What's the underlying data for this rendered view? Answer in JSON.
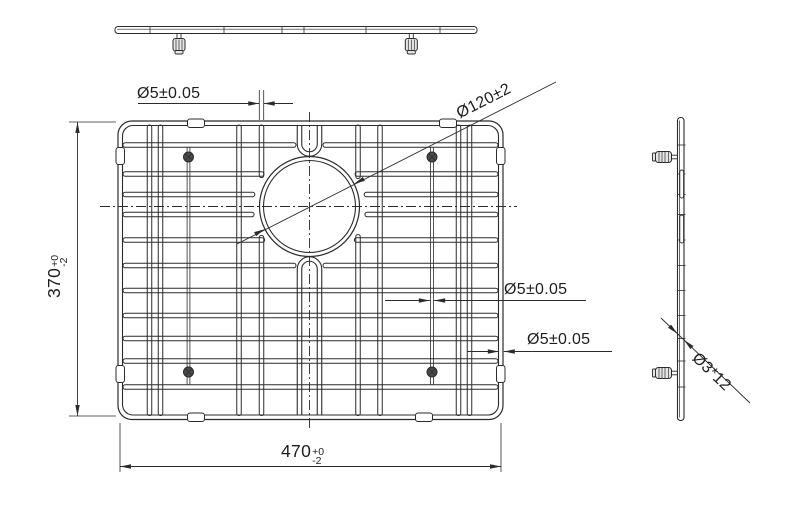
{
  "drawing": {
    "labels": {
      "height_dim": {
        "value": "370",
        "tol_plus": "+0",
        "tol_minus": "-2"
      },
      "width_dim": {
        "value": "470",
        "tol_plus": "+0",
        "tol_minus": "-2"
      },
      "wire_dia_top": "Ø5±0.05",
      "wire_dia_mid": "Ø5±0.05",
      "wire_dia_frame": "Ø5±0.05",
      "hole_dia": "Ø120±2",
      "leg_pin": "Ø3*12"
    },
    "colors": {
      "line": "#2b2b2b",
      "thin": "#3a3a3a",
      "background": "#ffffff",
      "foot_fill": "#4a4a4a",
      "clip_fill": "#ffffff",
      "shade_fill": "#e6e6e6"
    },
    "geometry": {
      "canvas": {
        "w": 800,
        "h": 516
      },
      "top_view": {
        "bar": {
          "x1": 115,
          "x2": 477,
          "y1": 26.5,
          "y2": 33.5,
          "rx": 3,
          "inner_y": 29.2
        },
        "ticks": [
          150,
          224,
          282,
          304,
          366,
          440
        ],
        "feet_x": [
          179,
          411.3
        ]
      },
      "front_view": {
        "frame": {
          "x1": 118,
          "y1": 121,
          "x2": 503,
          "y2": 419.5,
          "rx": 14,
          "t": 4.5
        },
        "h_wires": [
          145,
          174,
          194.5,
          214.5,
          240,
          265.5,
          290.5,
          315.5,
          338.5,
          361,
          387
        ],
        "h_gap_special": [
          145,
          265.5
        ],
        "v_wires": [
          149.5,
          160.5,
          239,
          261.5,
          358,
          380,
          458.5,
          469.5
        ],
        "v_interrupted": [
          261.5,
          358
        ],
        "wire_t": 4.5,
        "center_col": {
          "x_left": 299.5,
          "x_right": 319.5,
          "u_top_y": 144,
          "u_bot_y": 269
        },
        "circle": {
          "cx": 309.5,
          "cy": 206.5,
          "r": 50,
          "t": 4,
          "clear": 56
        },
        "legs": {
          "xs": [
            188.5,
            432
          ],
          "y1": 147,
          "y2": 385
        },
        "feet": [
          [
            188.5,
            157
          ],
          [
            432,
            157
          ],
          [
            188.5,
            372
          ],
          [
            432,
            372
          ]
        ],
        "clips": {
          "top_xs": [
            196,
            448
          ],
          "bottom_xs": [
            196,
            424
          ],
          "left_ys": [
            156,
            374
          ],
          "right_ys": [
            156,
            374
          ],
          "len": 17,
          "t": 8.5
        },
        "centerline_h": {
          "x1": 100,
          "x2": 517,
          "y": 206.5
        },
        "centerline_v": {
          "x": 309.5,
          "y1": 112,
          "y2": 431
        }
      },
      "side_view": {
        "bar": {
          "x1": 677.5,
          "x2": 684,
          "y1": 117.5,
          "y2": 420.5,
          "rx": 3,
          "inner_x": 679.5
        },
        "slots": [
          [
            170,
            198
          ],
          [
            215,
            243
          ]
        ],
        "feet_y": [
          157,
          373
        ]
      },
      "dims": {
        "height": {
          "line_x": 77.5,
          "y1": 122,
          "y2": 416,
          "ext_x1": 69,
          "ext_x2": 116
        },
        "width": {
          "line_y": 466.5,
          "x1": 120,
          "x2": 501,
          "ext_y1": 423,
          "ext_y2": 472
        },
        "leader_top": {
          "ext_xs": [
            259.3,
            263.7
          ],
          "ext_y1": 90,
          "ext_y2": 120,
          "y": 103.5,
          "tail_x1": 138,
          "tail_x2": 293
        },
        "leader_mid": {
          "y": 300.5,
          "ax1": 429.8,
          "ax2": 434.2,
          "tail_x1": 385,
          "tail_x2": 586
        },
        "leader_frame": {
          "y": 351.5,
          "ax1": 498.8,
          "ax2": 503.8,
          "tail_x1": 467,
          "tail_x2": 612
        },
        "leader_hole": {
          "x1": 237,
          "y1": 244,
          "x2": 556,
          "y2": 82
        },
        "leader_leg": {
          "x1": 661,
          "y1": 318,
          "x2": 750,
          "y2": 403,
          "bar_x1": 677.5,
          "bar_x2": 684
        }
      }
    }
  }
}
